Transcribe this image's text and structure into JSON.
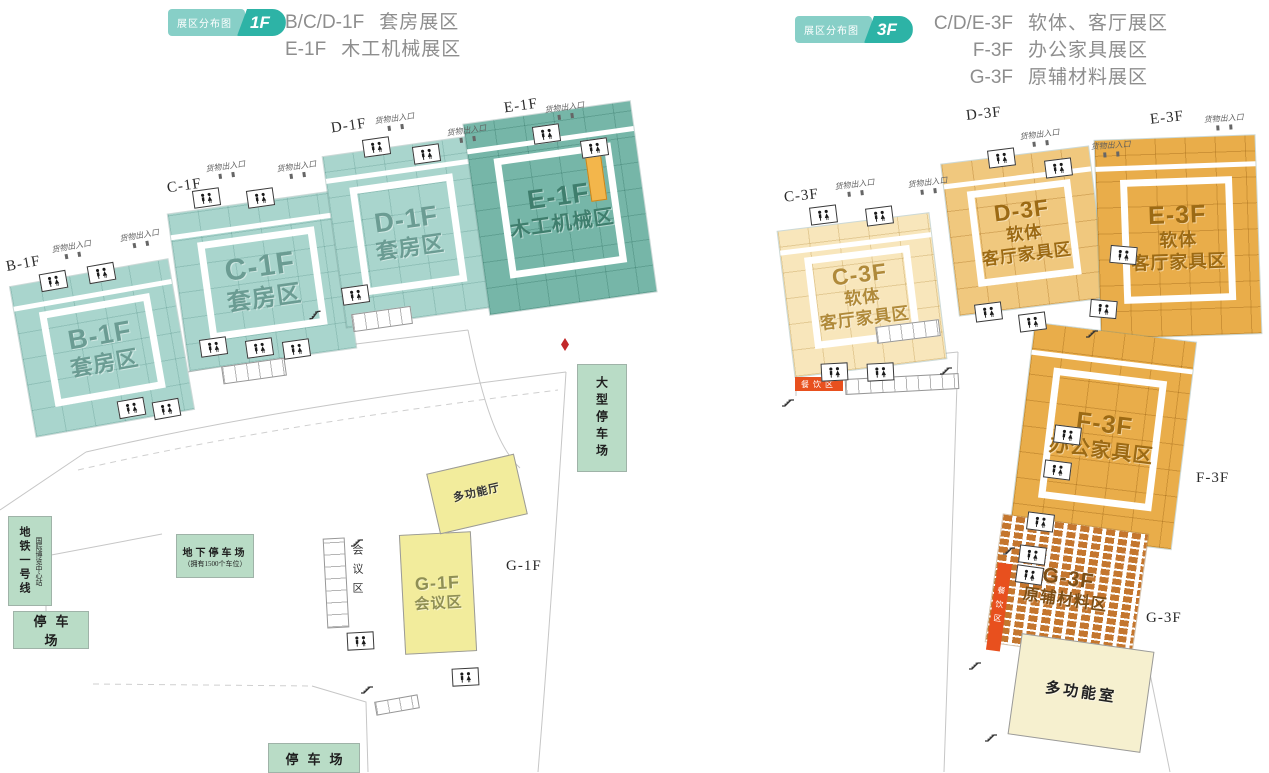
{
  "colors": {
    "badge": "#2db3a6",
    "badge_light": "#87cfc7",
    "teal": "#a9d5cd",
    "teal_dark": "#76b6a8",
    "cream": "#f8e6bb",
    "tan": "#f0c87e",
    "orange": "#e9ad4a",
    "brick": "#c4762e",
    "yellow": "#f2ec9c",
    "green": "#b9dcc6",
    "red": "#e8501e",
    "orange_strip": "#f3b64b",
    "text_gray": "#8e8e8e",
    "label_teal": "#6b9c93",
    "label_teal_dark": "#3f7e6d",
    "label_tan": "#b08a3a",
    "label_orange": "#9c6a14",
    "label_yellow": "#8f8f55",
    "label_brick": "#7d4f16"
  },
  "header_left": {
    "badge_text": "展区分布图",
    "badge_floor": "1F",
    "lines": [
      {
        "code": "B/C/D-1F",
        "name": "套房展区"
      },
      {
        "code": "E-1F",
        "name": "木工机械展区"
      }
    ]
  },
  "header_right": {
    "badge_text": "展区分布图",
    "badge_floor": "3F",
    "lines": [
      {
        "code": "C/D/E-3F",
        "name": "软体、客厅展区"
      },
      {
        "code": "F-3F",
        "name": "办公家具展区"
      },
      {
        "code": "G-3F",
        "name": "原辅材料展区"
      }
    ]
  },
  "labels": {
    "cargo": "货物出入口"
  },
  "floor1": {
    "halls": [
      {
        "code": "B-1F",
        "name": "套房区"
      },
      {
        "code": "C-1F",
        "name": "套房区"
      },
      {
        "code": "D-1F",
        "name": "套房区"
      },
      {
        "code": "E-1F",
        "name": "木工机械区"
      },
      {
        "code": "G-1F",
        "name": "会议区"
      }
    ],
    "outside_labels": {
      "b": "B-1F",
      "c": "C-1F",
      "d": "D-1F",
      "e": "E-1F",
      "g": "G-1F"
    },
    "multi_hall": "多功能厅",
    "meeting_col": "会议区",
    "metro_line": "地铁一号线",
    "metro_station": "国际博览中心站",
    "underground_parking_title": "地下停车场",
    "underground_parking_sub": "（拥有1500个车位）",
    "parking": "停车场",
    "parking_large": "大型停车场"
  },
  "floor3": {
    "halls": [
      {
        "code": "C-3F",
        "line1": "软体",
        "line2": "客厅家具区"
      },
      {
        "code": "D-3F",
        "line1": "软体",
        "line2": "客厅家具区"
      },
      {
        "code": "E-3F",
        "line1": "软体",
        "line2": "客厅家具区"
      },
      {
        "code": "F-3F",
        "line1": "办公家具区"
      },
      {
        "code": "G-3F",
        "line1": "原辅材料区"
      }
    ],
    "outside_labels": {
      "c": "C-3F",
      "d": "D-3F",
      "e": "E-3F",
      "f": "F-3F",
      "g": "G-3F"
    },
    "multi_room": "多功能室",
    "dining": "餐饮区"
  }
}
